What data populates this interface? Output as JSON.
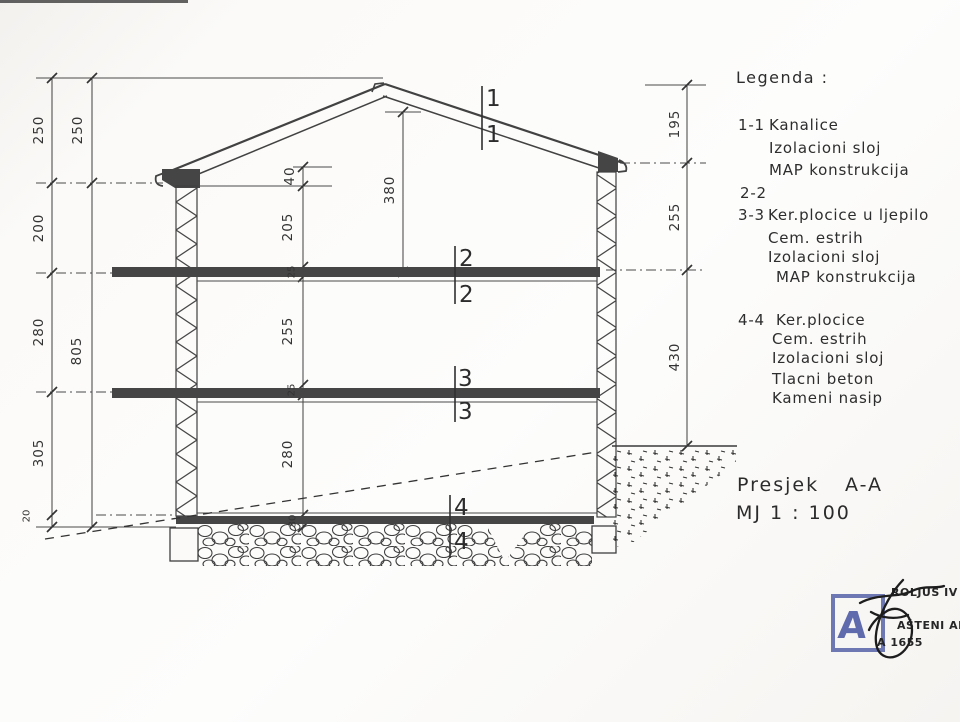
{
  "legend": {
    "title": "Legenda :",
    "items": [
      {
        "key": "1-1",
        "lines": [
          "Kanalice",
          "Izolacioni sloj",
          "MAP konstrukcija"
        ]
      },
      {
        "key": "2-2",
        "lines": []
      },
      {
        "key": "3-3",
        "lines": [
          "Ker.plocice u ljepilo",
          "Cem. estrih",
          "Izolacioni sloj",
          "MAP konstrukcija"
        ]
      },
      {
        "key": "4-4",
        "lines": [
          "Ker.plocice",
          "Cem. estrih",
          "Izolacioni sloj",
          "Tlacni beton",
          "Kameni nasip"
        ]
      }
    ]
  },
  "dimensions": {
    "left_outer": [
      "250",
      "200",
      "280",
      "305",
      "20"
    ],
    "left_total": [
      "250",
      "805"
    ],
    "interior": [
      "40",
      "205",
      "25",
      "255",
      "25",
      "280",
      "30"
    ],
    "ridge_height": "380",
    "right": [
      "195",
      "255",
      "430"
    ]
  },
  "section_marks": [
    "1",
    "2",
    "3",
    "4"
  ],
  "title_block": {
    "name": "Presjek",
    "section": "A-A",
    "scale": "MJ 1 : 100"
  },
  "stamp": {
    "letter": "A",
    "text_top": "ROLJUS IV",
    "text_mid": "AŠTENI AR",
    "text_bottom": "A 1655",
    "accent_color": "#5663a8"
  }
}
